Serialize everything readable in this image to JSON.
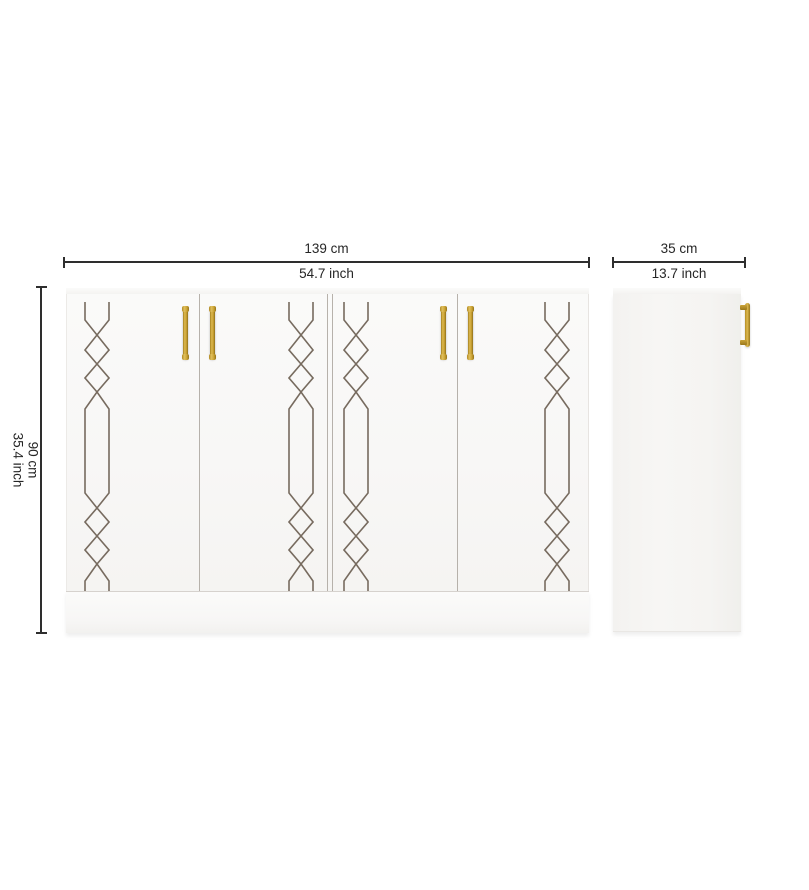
{
  "product": {
    "description": "white 4-door sideboard cabinet with gold handles and geometric inlay pattern",
    "views": {
      "front": "front view",
      "side": "side view"
    }
  },
  "dimensions": {
    "width": {
      "cm": "139 cm",
      "inch": "54.7 inch"
    },
    "depth": {
      "cm": "35 cm",
      "inch": "13.7 inch"
    },
    "height": {
      "cm": "90 cm",
      "inch": "35.4 inch"
    }
  },
  "colors": {
    "handle_gold": "#c9a237",
    "pattern_line": "#776b5f",
    "dimension_line": "#2e2e2e",
    "cabinet_white": "#fafaf9"
  }
}
